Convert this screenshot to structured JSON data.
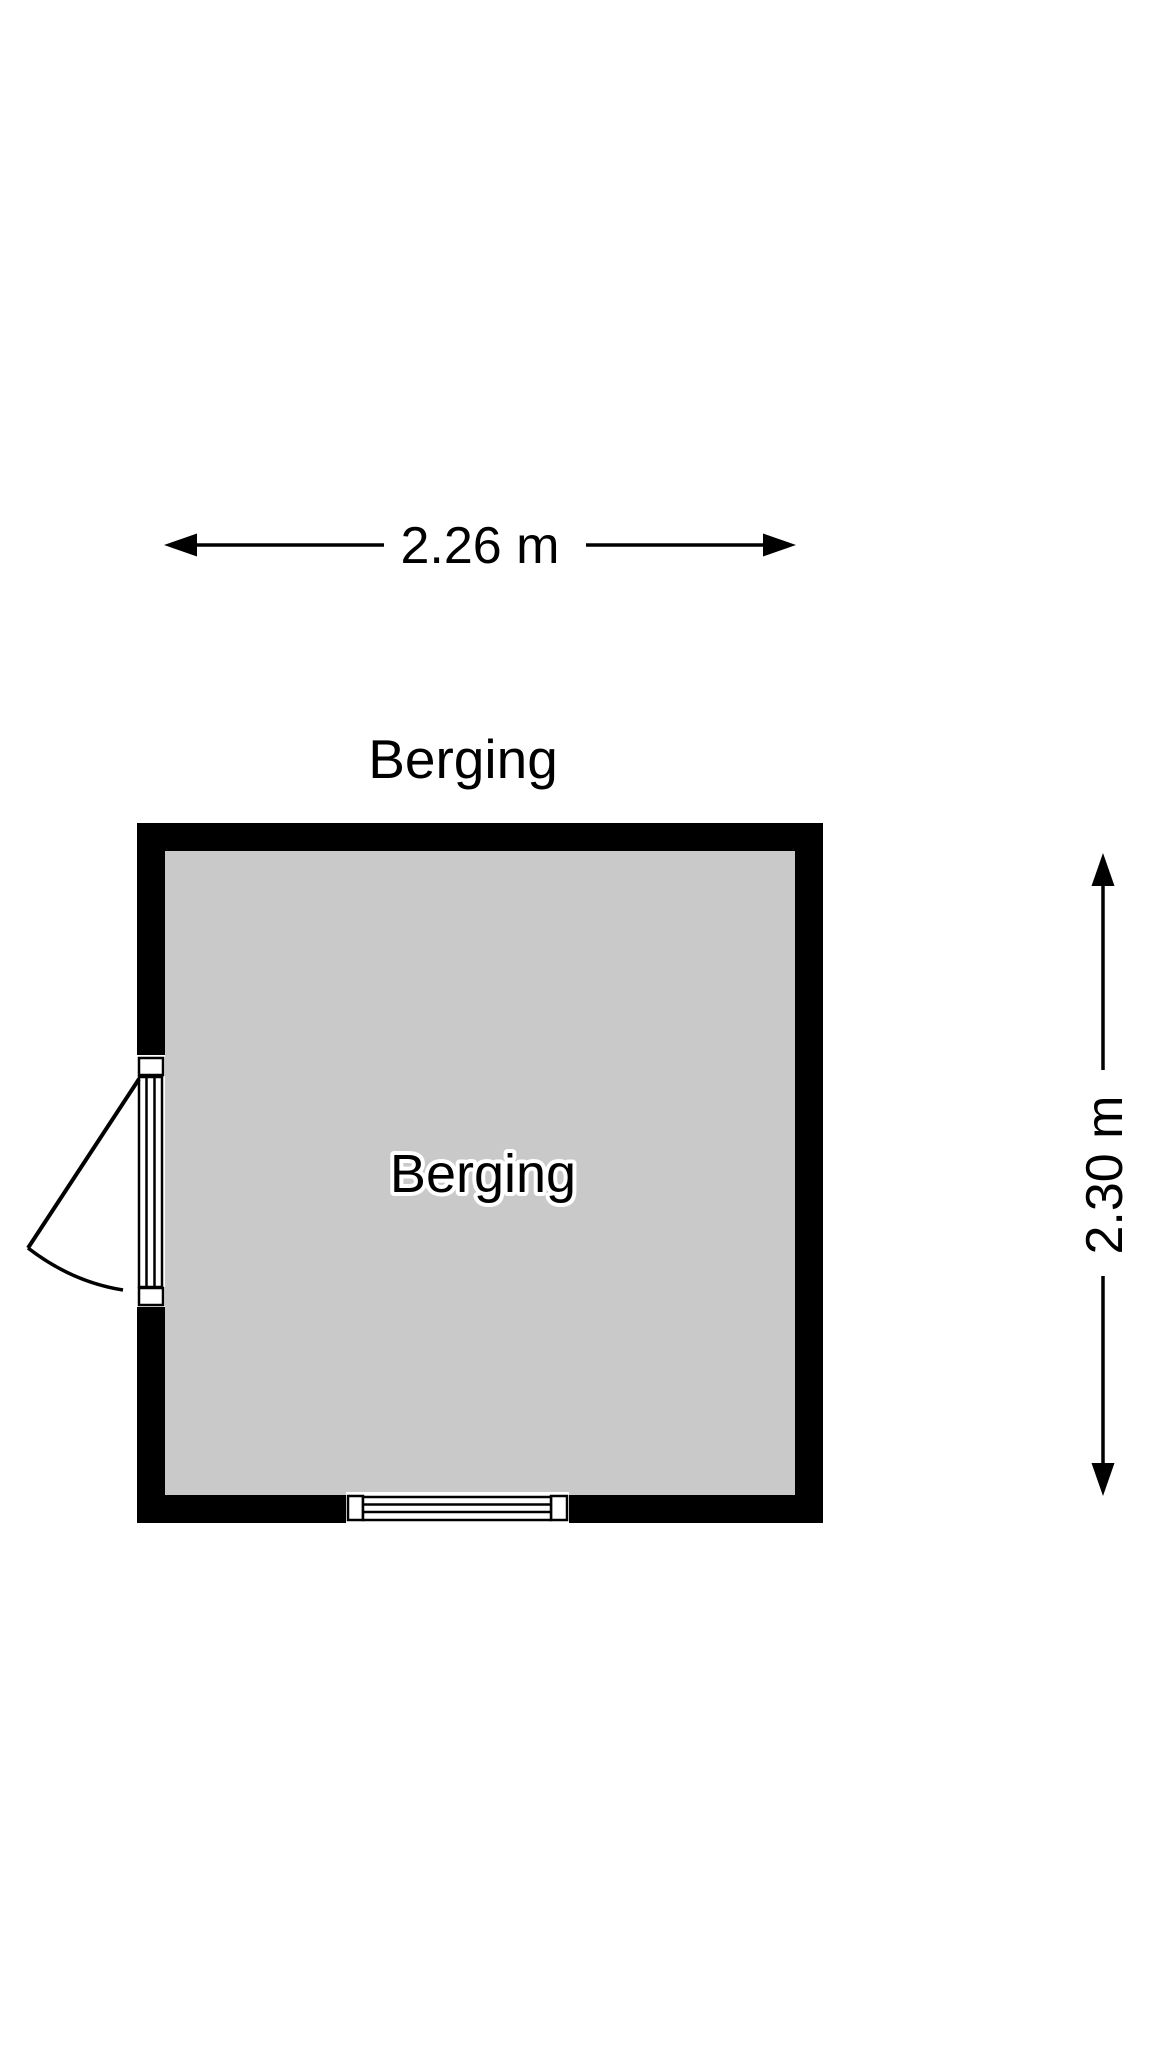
{
  "floorplan": {
    "title": "Berging",
    "room": {
      "label": "Berging"
    },
    "dimensions": {
      "width": {
        "label": "2.26 m"
      },
      "height": {
        "label": "2.30 m"
      }
    },
    "colors": {
      "background": "#ffffff",
      "wall": "#000000",
      "floor": "#c9c9c9",
      "line": "#000000"
    }
  }
}
